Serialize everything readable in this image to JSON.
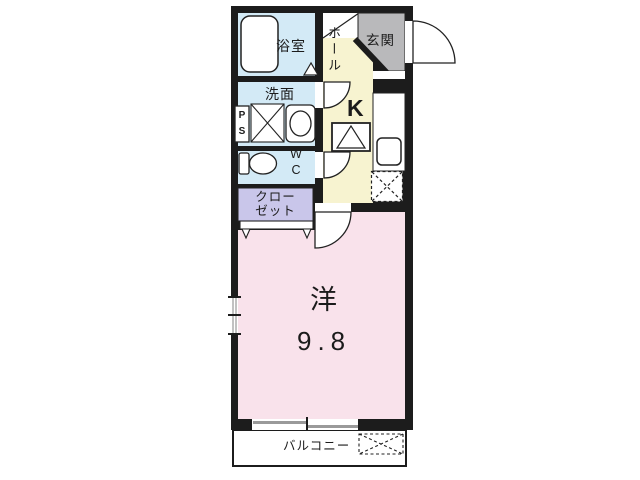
{
  "floor_plan": {
    "type": "apartment-floor-plan",
    "rooms": {
      "bathroom": {
        "label": "浴室"
      },
      "washroom": {
        "label": "洗面"
      },
      "toilet": {
        "label": "WC"
      },
      "pipe_space": {
        "label": "PS"
      },
      "closet": {
        "label": "クローゼット",
        "line1": "クロー",
        "line2": "ゼット"
      },
      "hall": {
        "label": "ホール"
      },
      "entrance": {
        "label": "玄関"
      },
      "kitchen": {
        "label": "K"
      },
      "main_room": {
        "label": "洋",
        "size": "9.8"
      },
      "balcony": {
        "label": "バルコニー"
      }
    },
    "colors": {
      "wall": "#1c1c1c",
      "wet_area": "#d3eaf6",
      "hall_kitchen": "#f7f3d0",
      "entrance": "#b9b9bb",
      "closet": "#c9c6ea",
      "main_room": "#f9e2eb",
      "background": "#ffffff",
      "fixture_fill": "#ffffff",
      "window_line": "#9a9a9a"
    },
    "fixtures": {
      "bathtub": "bathtub",
      "washing_machine_space": "crossed box",
      "basin": "round wash basin",
      "toilet_bowl": "toilet",
      "stove": "single burner box",
      "kitchen_sink": "rounded square sink",
      "refrigerator_space": "dashed crossed box",
      "outdoor_unit_space": "dashed crossed box"
    }
  }
}
